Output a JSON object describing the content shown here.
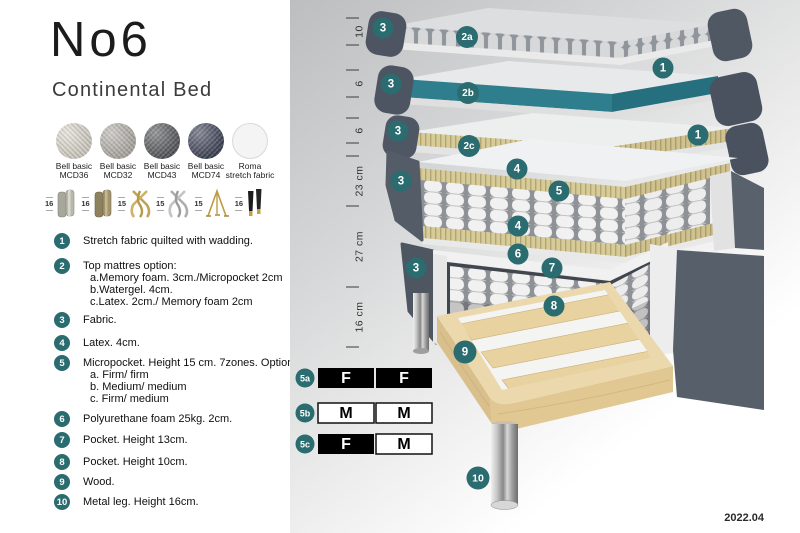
{
  "header": {
    "title": "No6",
    "subtitle": "Continental Bed"
  },
  "swatches": [
    {
      "line1": "Bell basic",
      "line2": "MCD36"
    },
    {
      "line1": "Bell basic",
      "line2": "MCD32"
    },
    {
      "line1": "Bell basic",
      "line2": "MCD43"
    },
    {
      "line1": "Bell basic",
      "line2": "MCD74"
    },
    {
      "line1": "Roma",
      "line2": "stretch fabric"
    }
  ],
  "legs": [
    {
      "height": "16",
      "type": "cylinder silver"
    },
    {
      "height": "16",
      "type": "cylinder brass"
    },
    {
      "height": "15",
      "type": "twisted gold"
    },
    {
      "height": "15",
      "type": "twisted silver"
    },
    {
      "height": "15",
      "type": "hairpin gold"
    },
    {
      "height": "16",
      "type": "tapered black gold tip"
    }
  ],
  "list": {
    "items": [
      {
        "num": "1",
        "text": "Stretch fabric quilted with wadding."
      },
      {
        "num": "2",
        "text": "Top mattres option:",
        "subs": [
          "a.Memory foam. 3cm./Micropocket 2cm",
          "b.Watergel. 4cm.",
          "c.Latex. 2cm./ Memory foam 2cm"
        ]
      },
      {
        "num": "3",
        "text": "Fabric."
      },
      {
        "num": "4",
        "text": "Latex. 4cm."
      },
      {
        "num": "5",
        "text": "Micropocket. Height 15 cm. 7zones. Option:",
        "subs": [
          "a. Firm/ firm",
          "b. Medium/ medium",
          "c. Firm/ medium"
        ]
      },
      {
        "num": "6",
        "text": "Polyurethane foam 25kg. 2cm."
      },
      {
        "num": "7",
        "text": "Pocket. Height 13cm."
      },
      {
        "num": "8",
        "text": "Pocket. Height 10cm."
      },
      {
        "num": "9",
        "text": "Wood."
      },
      {
        "num": "10",
        "text": "Metal leg. Height 16cm."
      }
    ]
  },
  "diagram": {
    "ruler": [
      "10",
      "6",
      "6",
      "23 cm",
      "27 cm",
      "16 cm"
    ],
    "labels": {
      "one": "1",
      "two_a": "2a",
      "two_b": "2b",
      "two_c": "2c",
      "three": "3",
      "four": "4",
      "five": "5",
      "six": "6",
      "seven": "7",
      "eight": "8",
      "nine": "9",
      "ten": "10"
    },
    "firmness": [
      {
        "id": "5a",
        "left": "F",
        "right": "F"
      },
      {
        "id": "5b",
        "left": "M",
        "right": "M"
      },
      {
        "id": "5c",
        "left": "F",
        "right": "M"
      }
    ],
    "version": "2022.04",
    "colors": {
      "accent_teal": "#2a6c6f",
      "watergel_teal": "#2e7e8e",
      "fabric_dark_gray": "#515864",
      "foam_yellow": "#d7cb97",
      "wood": "#ebd8ac"
    }
  }
}
